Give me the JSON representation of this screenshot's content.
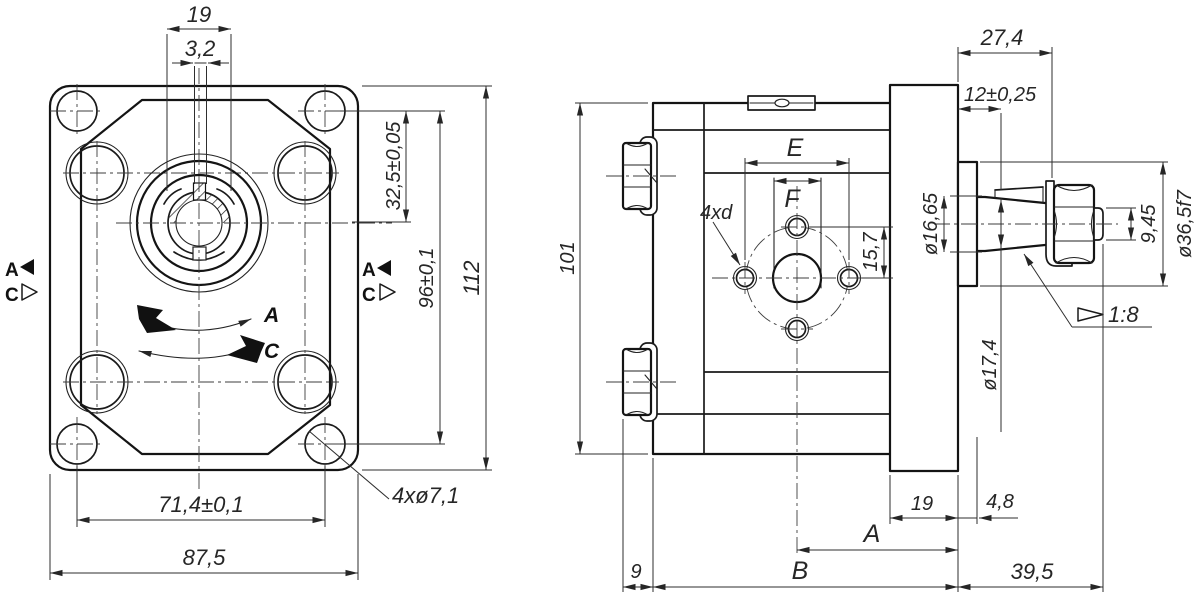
{
  "front_view": {
    "dim_key_diameter": "19",
    "dim_key_width": "3,2",
    "dim_shaft_to_holes": "32,5±0,05",
    "dim_hole_spacing_vertical": "96±0,1",
    "dim_flange_height": "112",
    "dim_hole_spacing_horizontal": "71,4±0,1",
    "dim_flange_width": "87,5",
    "label_mounting_holes": "4xø7,1",
    "port_marker_a": "A",
    "port_marker_c": "C",
    "rotation_label_a": "A",
    "rotation_label_c": "C"
  },
  "side_view": {
    "dim_body_height": "101",
    "dim_port_spacing": "E",
    "dim_port_width": "F",
    "label_port_holes": "4xd",
    "dim_port_offset": "15,7",
    "dim_shaft_length": "27,4",
    "dim_gauge_plane": "12±0,25",
    "dim_shaft_diameter": "ø16,65",
    "dim_thread_diameter": "9,45",
    "dim_collar_diameter": "ø36,5f7",
    "taper_ratio": "1:8",
    "dim_taper_diameter": "ø17,4",
    "dim_flange_thickness": "19",
    "dim_collar_thickness": "4,8",
    "dim_a": "A",
    "dim_b": "B",
    "dim_front_plate": "9",
    "dim_shaft_protrusion": "39,5"
  }
}
